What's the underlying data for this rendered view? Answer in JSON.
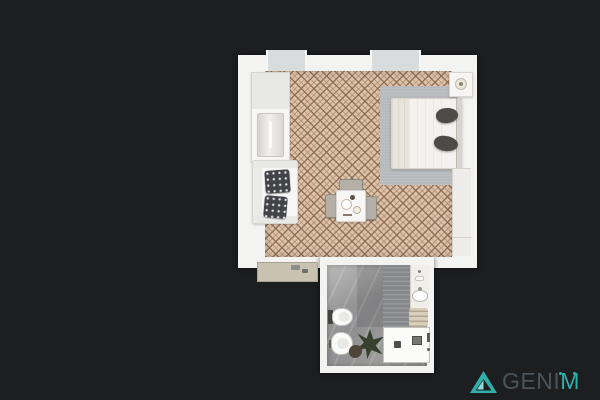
{
  "scene": {
    "type": "apartment floor plan render, top-down view",
    "background_color": "#1d1e1f"
  },
  "apartment": {
    "main_room": {
      "floor_finish": "beige diamond-lattice tile",
      "floor_color": "#ddc2aa",
      "tile_line_color": "#7a5a40",
      "window_count": 2,
      "furniture": {
        "wardrobe": "wardrobe cabinet (top-left)",
        "sofa": "white sofa with two dark patterned cushions (left)",
        "dining_set": "square dining table with three chairs (center)",
        "rug": "grey area rug",
        "bed": "double bed with dark pillows, headboard on right wall",
        "nightstand": "nightstand with lamp (top-right corner)",
        "sideboard": "long sideboard along right wall",
        "entry_console": "beige console strip at bottom-left exterior"
      }
    },
    "bathroom": {
      "floor_finish": "grey marble tile",
      "floor_color": "#979798",
      "fixtures": {
        "toilet": "wall-hung toilet",
        "bidet": "bidet",
        "vanity": "vanity with oval sink",
        "towels": "towel shelf",
        "plant": "potted plant",
        "shower": "walk-in shower tray with drain"
      }
    }
  },
  "watermark": {
    "brand": "GENIM",
    "text_part_gray": "GENI",
    "text_part_teal": "M",
    "accent_color": "#2fb0ad",
    "text_color": "#4a555b",
    "icon": "triangle-logo"
  }
}
